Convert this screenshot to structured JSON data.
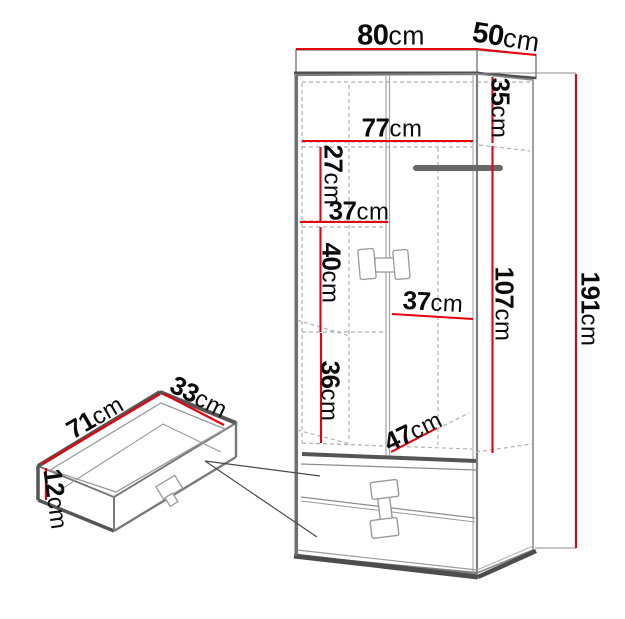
{
  "labels": {
    "width_80": {
      "value": "80",
      "unit": "cm"
    },
    "depth_50": {
      "value": "50",
      "unit": "cm"
    },
    "top_section_35": {
      "value": "35",
      "unit": "cm"
    },
    "interior_77": {
      "value": "77",
      "unit": "cm"
    },
    "shelf_gap_27": {
      "value": "27",
      "unit": "cm"
    },
    "left_width_37": {
      "value": "37",
      "unit": "cm"
    },
    "shelf_gap_40": {
      "value": "40",
      "unit": "cm"
    },
    "right_width_37": {
      "value": "37",
      "unit": "cm"
    },
    "hanging_107": {
      "value": "107",
      "unit": "cm"
    },
    "shelf_gap_36": {
      "value": "36",
      "unit": "cm"
    },
    "floor_depth_47": {
      "value": "47",
      "unit": "cm"
    },
    "height_191": {
      "value": "191",
      "unit": "cm"
    },
    "drawer_width_71": {
      "value": "71",
      "unit": "cm"
    },
    "drawer_depth_33": {
      "value": "33",
      "unit": "cm"
    },
    "drawer_height_12": {
      "value": "12",
      "unit": "cm"
    }
  },
  "colors": {
    "dimension_line": "#e8000d",
    "outline": "#7a7a7a",
    "dark_edge": "#4d4d4d",
    "hidden_line": "#b0b0b0",
    "rail": "#686868",
    "text": "#0b0b0b"
  }
}
